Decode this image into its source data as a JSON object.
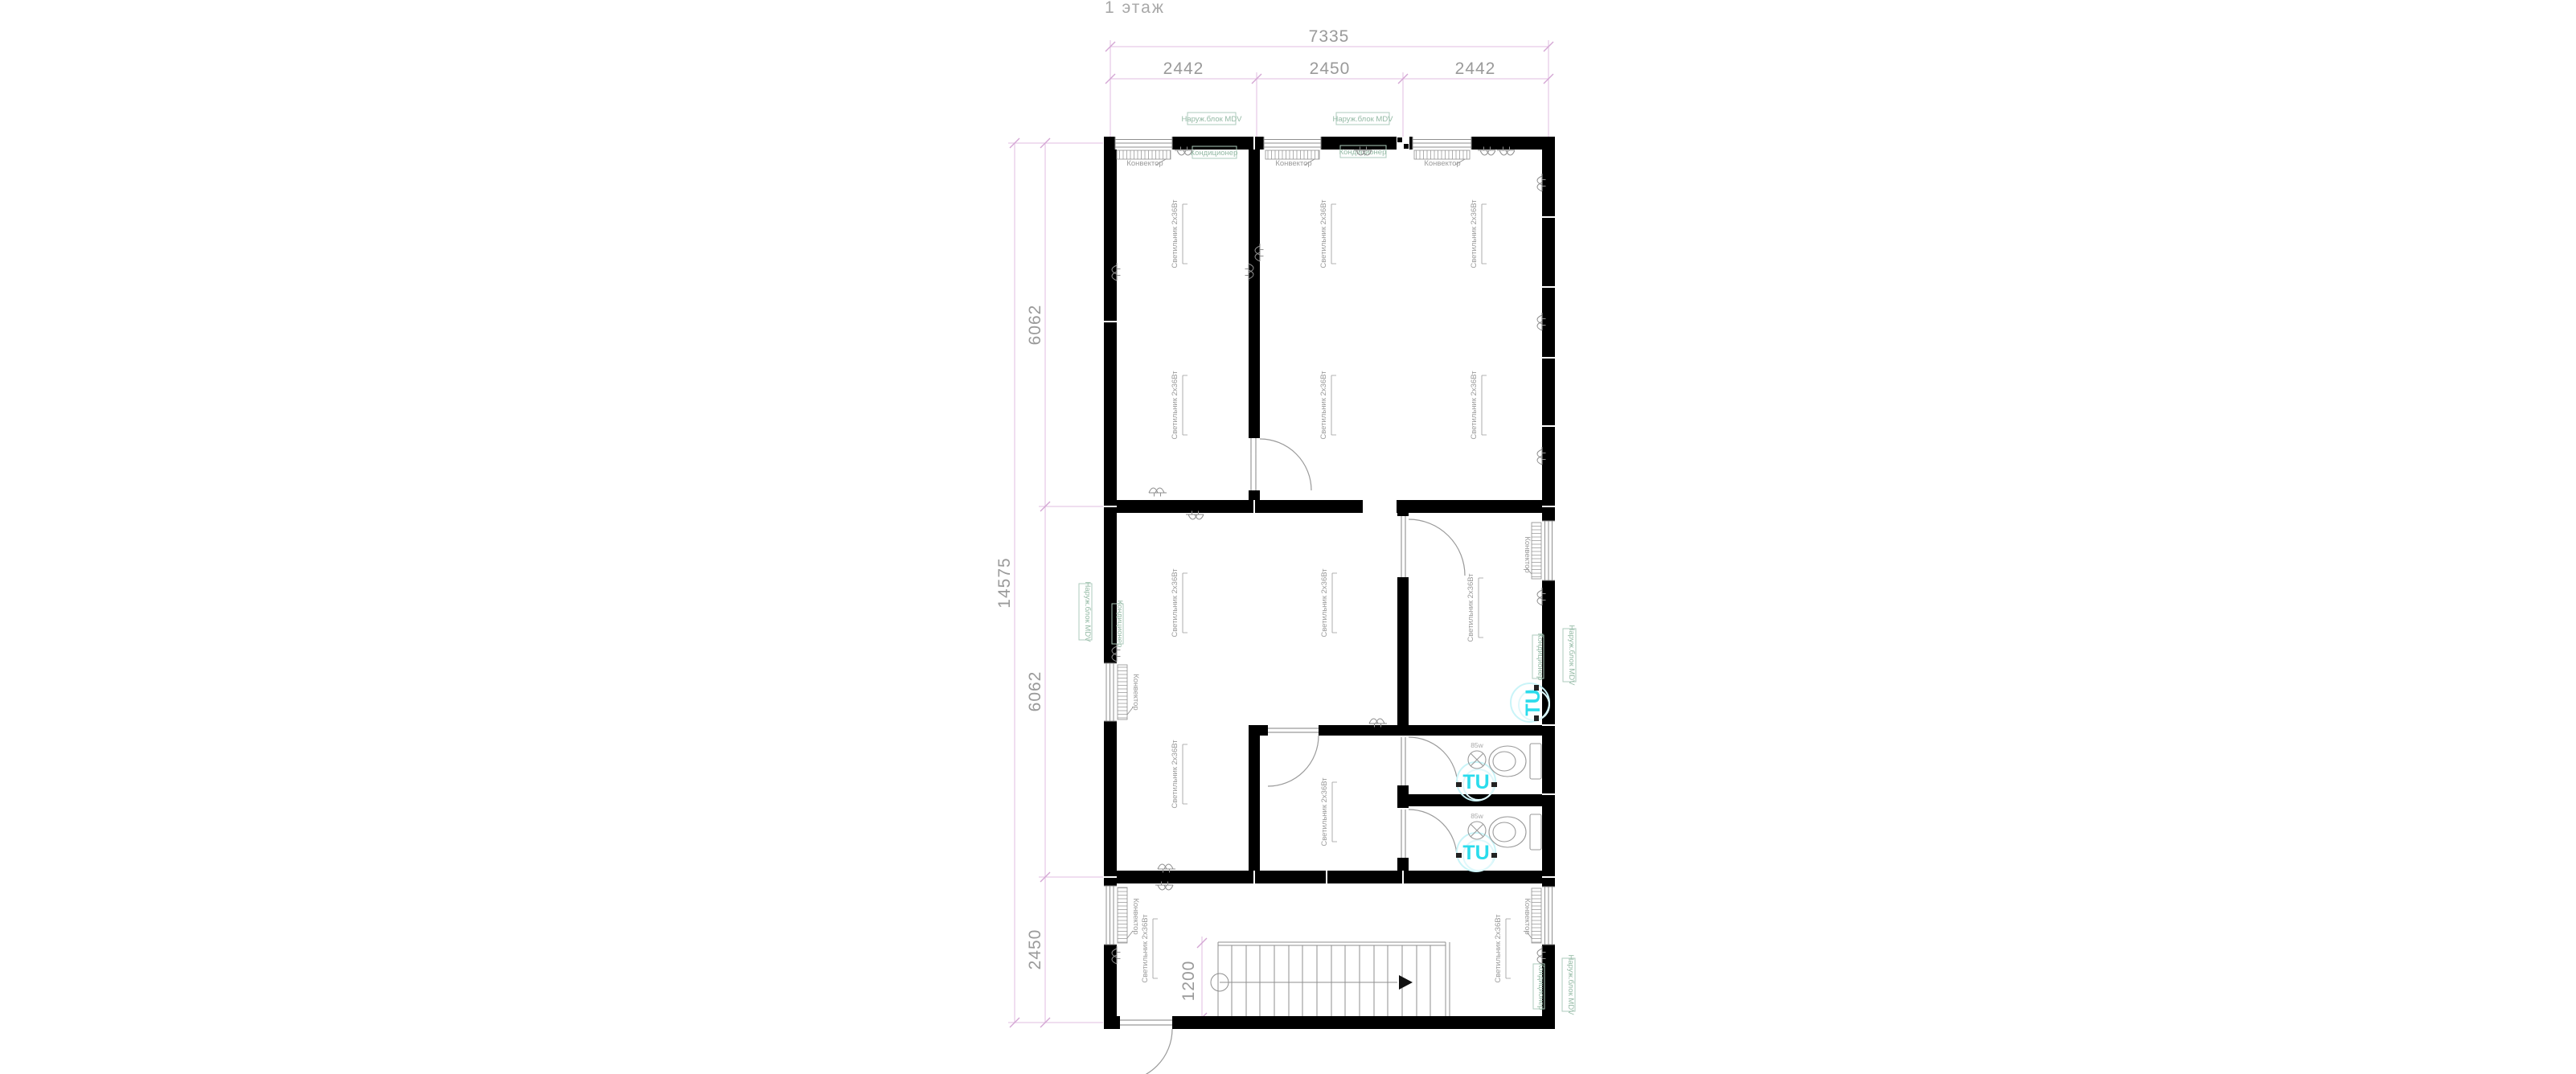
{
  "title": "1 этаж",
  "dimensions": {
    "top_total": "7335",
    "top_segments": [
      "2442",
      "2450",
      "2442"
    ],
    "left_total": "14575",
    "left_segments": [
      "6062",
      "6062",
      "2450"
    ],
    "stair_width": "1200"
  },
  "labels": {
    "light": "Светильник 2x36Вт",
    "convector": "Конвектор",
    "ac_indoor": "Кондиционер",
    "ac_outdoor": "Наруж.блок MDV",
    "fan_unit": "TU",
    "bath_lamp": "85w"
  },
  "colors": {
    "wall": "#000000",
    "thin_line": "#8f8f8f",
    "text_gray": "#9a9a9a",
    "dim_line": "#e7c9e7",
    "dim_tick": "#d4a6d4",
    "equip_green": "#93b9a4",
    "fan_cyan": "#2bdcec"
  }
}
